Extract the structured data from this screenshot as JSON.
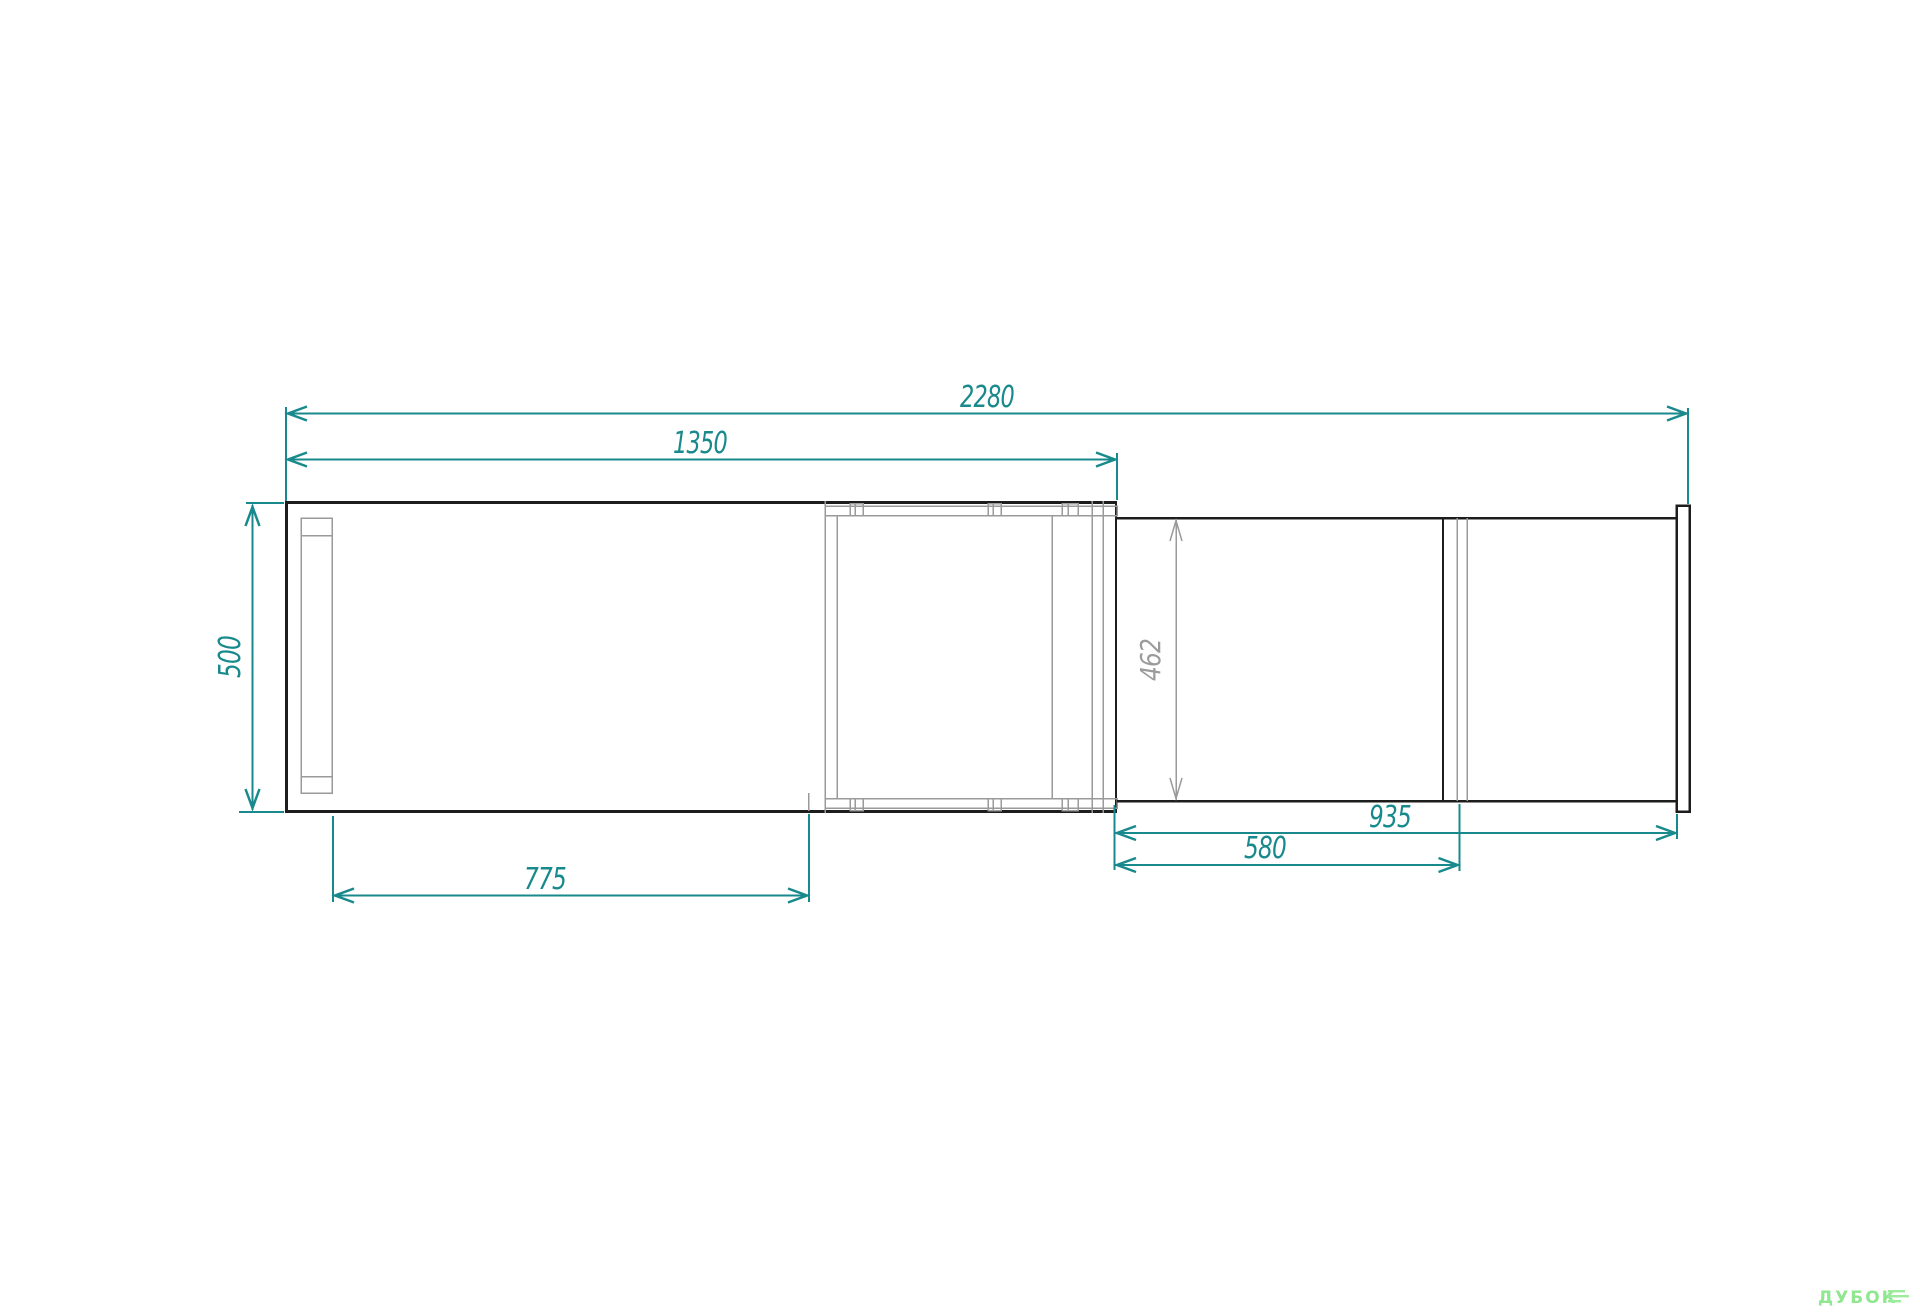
{
  "drawing": {
    "title": "furniture-top-view-technical-drawing",
    "dimensions": {
      "total_width": "2280",
      "cabinet_width": "1350",
      "cabinet_depth": "500",
      "door_opening_width": "775",
      "pullout_depth": "462",
      "pullout_width": "935",
      "pullout_inner_width": "580"
    },
    "colors": {
      "dimension_teal": "#18898c",
      "outline_dark": "#1d1d1d",
      "detail_gray": "#9a9a9a",
      "logo_green": "#8fe78f"
    }
  },
  "logo": {
    "brand": "ДУБОК"
  }
}
